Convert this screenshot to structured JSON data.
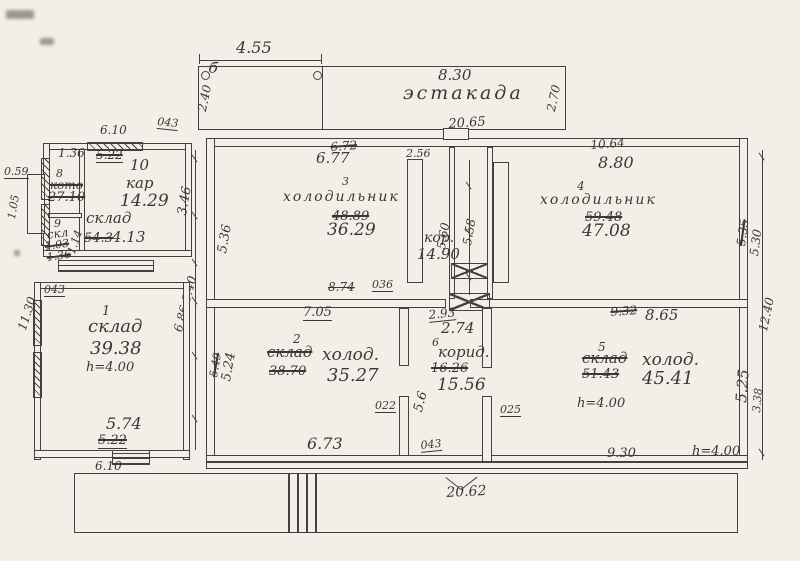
{
  "ramp": {
    "name": "эстакада",
    "dim_top": "4.55",
    "mark": "б",
    "dim_left": "2.40",
    "dim_width": "8.30",
    "dim_right": "2.70"
  },
  "building": {
    "dim_top": "20.65",
    "dim_top_small": "2.56",
    "dim_bottom": "20.62",
    "dim_right": "12.40"
  },
  "annex": {
    "dim_top": "6.10",
    "wall_thk": "043",
    "dim_1": "1.36",
    "dim_1_old": "5.22",
    "dim_left": "0.59",
    "dim_left_v": "1.05",
    "room8_no": "8",
    "room8_name": "кото",
    "room8_area": "27.10",
    "room10_no": "10",
    "room10_name": "кар",
    "room10_area": "14.29",
    "room9_no": "9",
    "room9_name": "скл",
    "room9_area": "1.03",
    "room9_dim": "1.36",
    "room9_dim2": "1.14",
    "sklad_name": "склад",
    "sklad_old": "54.3",
    "sklad_area": "4.13",
    "gap_dim": "3.46",
    "gap_dim2": "6.86·0.40"
  },
  "room1": {
    "no": "1",
    "name": "склад",
    "area": "39.38",
    "height": "h=4.00",
    "wall_thk": "043",
    "dim_left": "11.30",
    "dim_bottom": "5.74",
    "dim_bottom_old": "5.22",
    "dim_outside": "6.10"
  },
  "room3": {
    "no": "3",
    "name": "холодильник",
    "area": "36.29",
    "area_old": "48.89",
    "dim_top": "6.77",
    "dim_top_old": "6.72",
    "dim_left": "5.36"
  },
  "corr_top": {
    "name": "кор.",
    "area": "14.90",
    "dim_1": "5.60",
    "dim_2": "5.58"
  },
  "room4": {
    "no": "4",
    "name": "холодильник",
    "area": "47.08",
    "area_old": "59.48",
    "dim_top": "10.64",
    "dim_top2": "8.80",
    "dim_right_old": "5.35",
    "dim_right": "5.30"
  },
  "midwall": {
    "dim_old": "8.74",
    "thk": "036",
    "dim": "7.05"
  },
  "room2": {
    "no": "2",
    "name": "холод.",
    "name_old": "склад",
    "area": "35.27",
    "area_old": "38.70",
    "dim_left": "5.24",
    "dim_left_old": "5.49",
    "dim_bottom": "6.73",
    "wall_thk": "022"
  },
  "corr6": {
    "no": "6",
    "name": "корид.",
    "area": "15.56",
    "area_old": "16.26",
    "width": "2.74",
    "width_old": "2.93",
    "dim_v": "5.6",
    "wall_thk": "025",
    "wall_thk2": "043"
  },
  "room5": {
    "no": "5",
    "name": "холод.",
    "name_old": "склад",
    "area": "45.41",
    "area_old": "51.43",
    "dim_top": "8.65",
    "dim_top_old": "9.32",
    "height": "h=4.00",
    "dim_bottom": "9.30",
    "height2": "h=4.00",
    "dim_right": "5.25",
    "dim_right2": "3.38"
  }
}
